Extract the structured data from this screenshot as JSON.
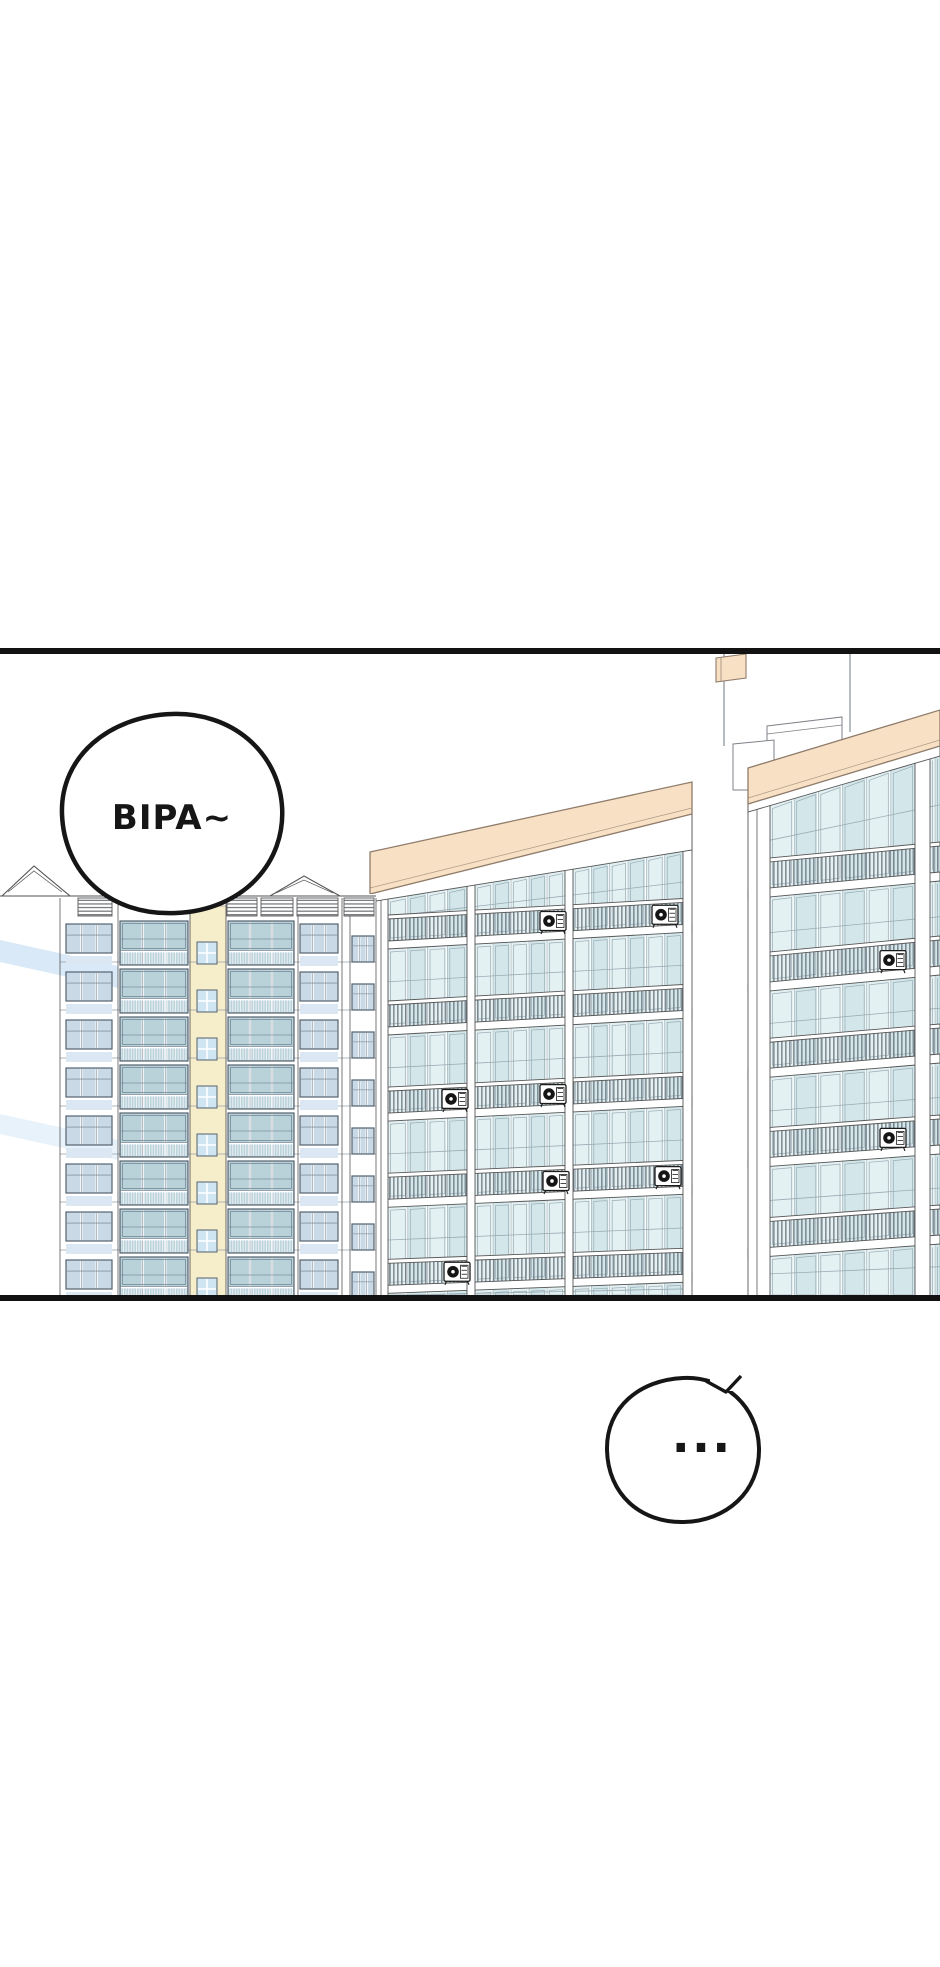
{
  "page": {
    "width": 940,
    "height": 1967,
    "background": "#ffffff"
  },
  "panel": {
    "top_border_y": 648,
    "bottom_border_y": 1295,
    "border_thickness": 6,
    "border_color": "#121212"
  },
  "bubbles": [
    {
      "name": "bipa-speech-bubble",
      "text": "BIPA~"
    },
    {
      "name": "ellipsis-speech-bubble",
      "text": "..."
    }
  ],
  "scene": {
    "description": "Low-angle view of an apartment complex: one high-rise with cream stairwell strip on the left, two peach-roofed apartment blocks with teal balcony glazing, balcony railings and air-conditioner units; rooftop chimney pole with small peach flag",
    "building_count": 3,
    "ac_unit_count": 9
  },
  "colors": {
    "outline": "#565656",
    "frame_line": "#9aacb4",
    "roof_peach": "#f8e0c4",
    "roof_edge": "#8f7c6b",
    "glass_light": "#e4f1f3",
    "glass_mid": "#d3e7eb",
    "left_glass": "#b9d2da",
    "left_small_glass": "#c9dae6",
    "spandrel_blue": "#dbe8f4",
    "stair_cream": "#f6eecb",
    "stair_cream_edge": "#a89f83",
    "stair_window": "#cfe6f2",
    "railing_bar": "#6e7880",
    "pale_blue_stripe": "#d9e9f7",
    "chimney_line": "#8a8f94",
    "penthouse_edge": "#7d8287",
    "ac_dark": "#1b1b1b",
    "bubble_fill": "#ffffff",
    "bubble_stroke": "#161616",
    "text_color": "#161616"
  }
}
